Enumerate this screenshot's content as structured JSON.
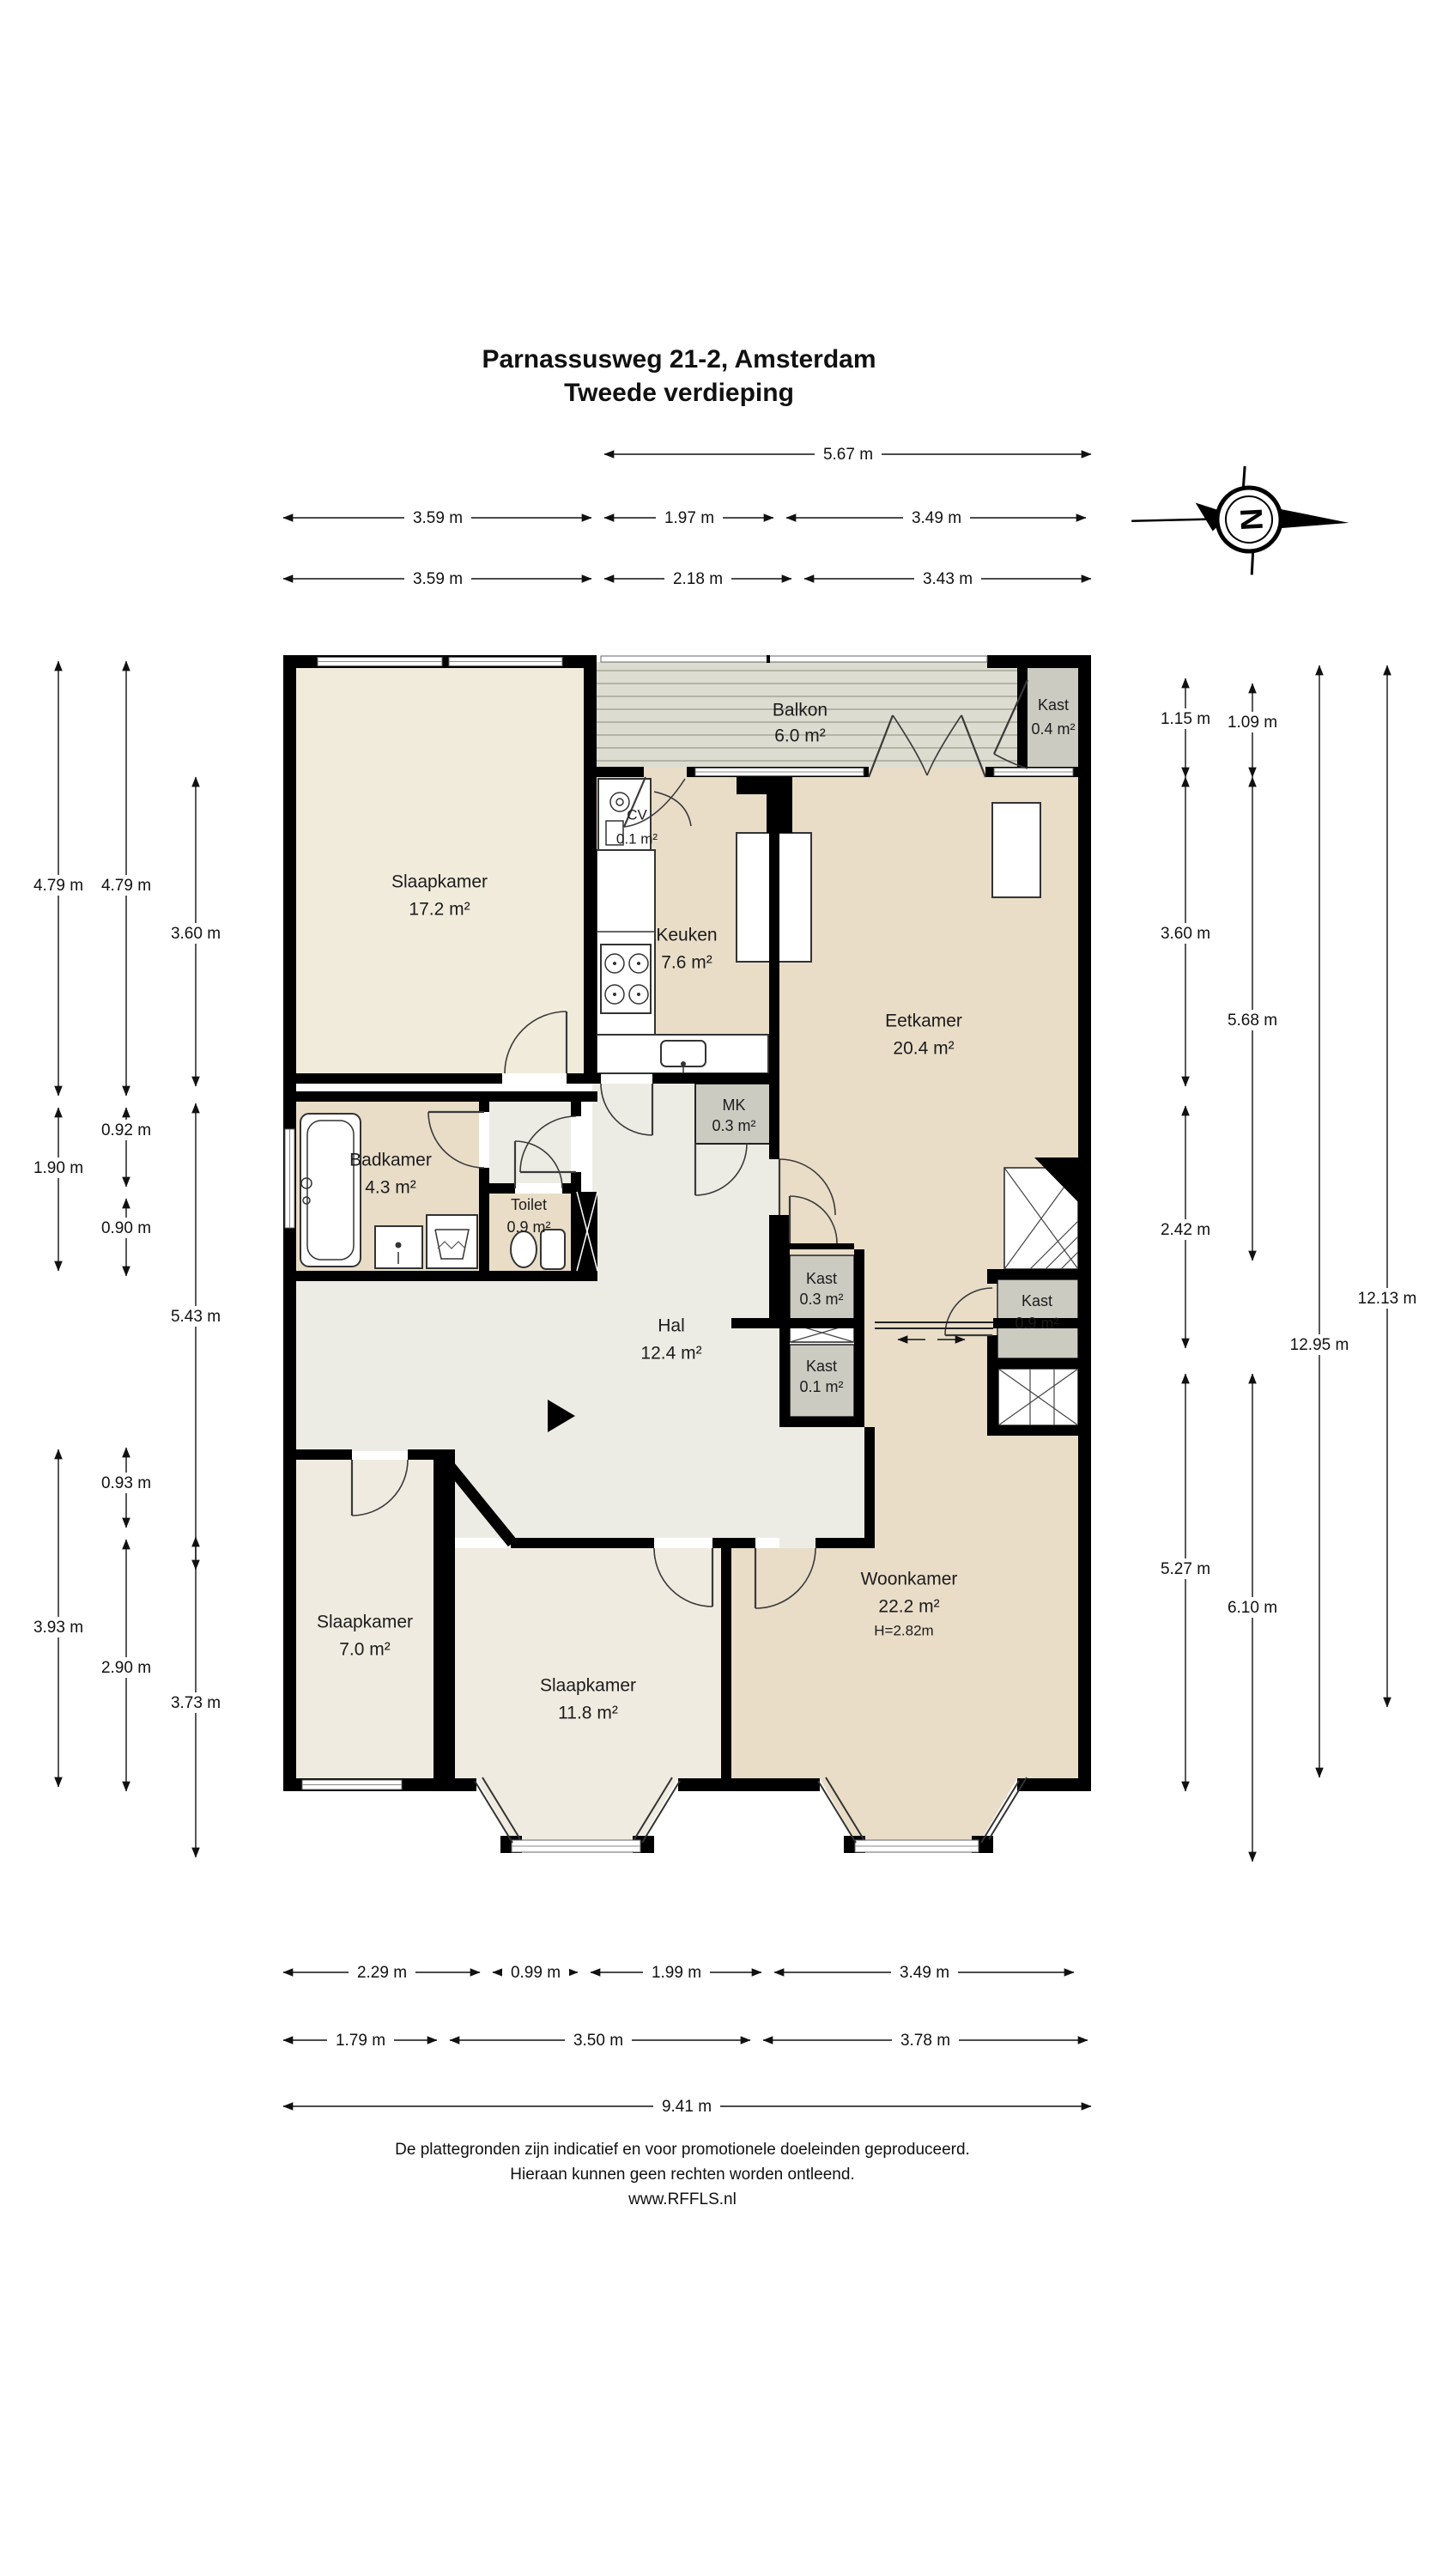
{
  "title": {
    "line1": "Parnassusweg 21-2, Amsterdam",
    "line2": "Tweede verdieping"
  },
  "compass": {
    "letter": "N"
  },
  "rooms": {
    "slaapkamer1": {
      "name": "Slaapkamer",
      "area": "17.2 m²"
    },
    "balkon": {
      "name": "Balkon",
      "area": "6.0 m²"
    },
    "kast_balkon": {
      "name": "Kast",
      "area": "0.4 m²"
    },
    "cv": {
      "name": "CV",
      "area": "0.1 m²"
    },
    "keuken": {
      "name": "Keuken",
      "area": "7.6 m²"
    },
    "eetkamer": {
      "name": "Eetkamer",
      "area": "20.4 m²"
    },
    "badkamer": {
      "name": "Badkamer",
      "area": "4.3 m²"
    },
    "toilet": {
      "name": "Toilet",
      "area": "0.9 m²"
    },
    "mk": {
      "name": "MK",
      "area": "0.3 m²"
    },
    "hal": {
      "name": "Hal",
      "area": "12.4 m²"
    },
    "kast_midden1": {
      "name": "Kast",
      "area": "0.3 m²"
    },
    "kast_midden2": {
      "name": "Kast",
      "area": "0.1 m²"
    },
    "kast_rechts": {
      "name": "Kast",
      "area": "0.9 m²"
    },
    "woonkamer": {
      "name": "Woonkamer",
      "area": "22.2 m²",
      "height": "H=2.82m"
    },
    "slaapkamer2": {
      "name": "Slaapkamer",
      "area": "7.0 m²"
    },
    "slaapkamer3": {
      "name": "Slaapkamer",
      "area": "11.8 m²"
    }
  },
  "dimensions": {
    "top": {
      "row1": [
        "5.67 m"
      ],
      "row2": [
        "3.59 m",
        "1.97 m",
        "3.49 m"
      ],
      "row3": [
        "3.59 m",
        "2.18 m",
        "3.43 m"
      ]
    },
    "bottom": {
      "row1": [
        "2.29 m",
        "0.99 m",
        "1.99 m",
        "3.49 m"
      ],
      "row2": [
        "1.79 m",
        "3.50 m",
        "3.78 m"
      ],
      "row3": [
        "9.41 m"
      ]
    },
    "left": {
      "col1": [
        "4.79 m",
        "1.90 m",
        "3.93 m"
      ],
      "col2": [
        "4.79 m",
        "0.92 m",
        "0.90 m",
        "0.93 m",
        "2.90 m"
      ],
      "col3": [
        "3.60 m",
        "5.43 m",
        "3.73 m"
      ]
    },
    "right": {
      "col1": [
        "1.15 m",
        "3.60 m",
        "2.42 m",
        "5.27 m"
      ],
      "col2": [
        "1.09 m",
        "5.68 m",
        "6.10 m"
      ],
      "col3": [
        "12.95 m"
      ],
      "col4": [
        "12.13 m"
      ]
    }
  },
  "footer": {
    "line1": "De plattegronden zijn indicatief en voor promotionele doeleinden geproduceerd.",
    "line2": "Hieraan kunnen geen rechten worden ontleend.",
    "line3": "www.RFFLS.nl"
  },
  "colors": {
    "wall": "#000000",
    "bedroom_floor": "#F1EBDC",
    "living_floor": "#E9DDC8",
    "hall_floor": "#EDECE4",
    "closet_floor": "#CBCBC2",
    "balcony_floor": "#DCDCD1"
  }
}
